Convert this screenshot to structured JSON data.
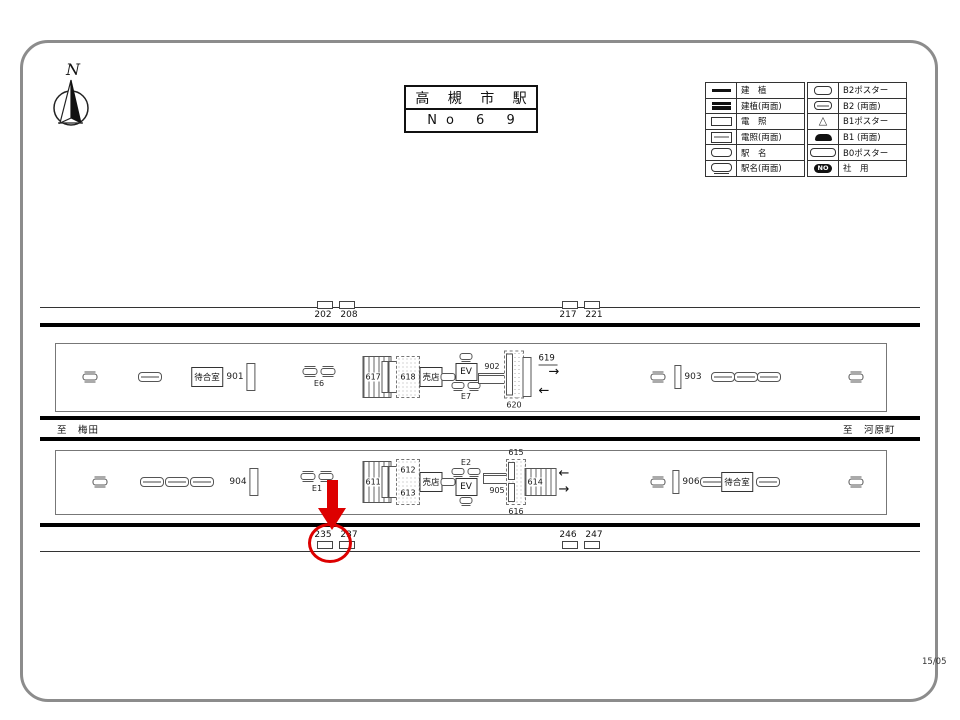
{
  "header": {
    "compass_label": "N",
    "title": "高 槻 市 駅",
    "number": "No 6 9"
  },
  "legend": {
    "rows_left": [
      {
        "icon": "kenshoku",
        "label": "建　植"
      },
      {
        "icon": "kenshoku-ryomen",
        "label": "建植(両面)"
      },
      {
        "icon": "densho",
        "label": "電　照"
      },
      {
        "icon": "densho-ryomen",
        "label": "電照(両面)"
      },
      {
        "icon": "ekimei",
        "label": "駅　名"
      },
      {
        "icon": "ekimei-ryomen",
        "label": "駅名(両面)"
      }
    ],
    "rows_right": [
      {
        "icon": "b2-poster",
        "label": "B2ポスター"
      },
      {
        "icon": "b2-ryomen",
        "label": "B2 (両面)"
      },
      {
        "icon": "b1-poster",
        "label": "B1ポスター"
      },
      {
        "icon": "b1-ryomen",
        "label": "B1 (両面)"
      },
      {
        "icon": "b0-poster",
        "label": "B0ポスター"
      },
      {
        "icon": "no-badge",
        "badge": "NO",
        "label": "社　用"
      }
    ]
  },
  "map": {
    "to_left": "至　梅田",
    "to_right": "至　河原町",
    "sheet_code": "15/05",
    "top_markers": [
      {
        "x": 336,
        "labels": [
          "202",
          "208"
        ]
      },
      {
        "x": 581,
        "labels": [
          "217",
          "221"
        ]
      }
    ],
    "bottom_markers": [
      {
        "x": 336,
        "labels": [
          "235",
          "237"
        ]
      },
      {
        "x": 581,
        "labels": [
          "246",
          "247"
        ]
      }
    ],
    "highlight": {
      "target": "235",
      "color": "#dd0000",
      "arrow": {
        "x": 332,
        "top": 480,
        "shaft_h": 28,
        "head_h": 22
      },
      "circle": {
        "cx": 330,
        "cy": 543,
        "rx": 19,
        "ry": 17
      }
    },
    "platforms": [
      {
        "name": "platform-top",
        "box": {
          "x": 55,
          "y": 343,
          "w": 830,
          "h": 67
        },
        "items": [
          {
            "t": "sym2",
            "x": 90
          },
          {
            "t": "oval",
            "x": 150
          },
          {
            "t": "room",
            "x": 207,
            "label": "待合室"
          },
          {
            "t": "numbar",
            "x": 241,
            "label": "901"
          },
          {
            "t": "sympair",
            "x": 319,
            "label": "E6"
          },
          {
            "t": "stairs",
            "x": 377,
            "label": "617",
            "w": 27,
            "h": 40
          },
          {
            "t": "vrect",
            "x": 393,
            "h": 30
          },
          {
            "t": "dashedbox",
            "x": 408,
            "label": "618",
            "w": 22,
            "h": 40
          },
          {
            "t": "room",
            "x": 431,
            "label": "売店"
          },
          {
            "t": "ovalsm",
            "x": 448
          },
          {
            "t": "ev",
            "x": 466,
            "label": "EV",
            "bottomLabel": "E7",
            "topSyms": 1,
            "bottomSyms": 2
          },
          {
            "t": "densho",
            "x": 492,
            "label": "902",
            "labelPos": "top",
            "dy": -4
          },
          {
            "t": "dashedbars",
            "x": 514,
            "labelBottom": "620",
            "w": 18,
            "h": 46,
            "bars": "full",
            "dy": 3
          },
          {
            "t": "vrect",
            "x": 527,
            "h": 38
          },
          {
            "t": "arrows",
            "x": 549,
            "label": "619",
            "dy": -2
          },
          {
            "t": "sym2",
            "x": 658
          },
          {
            "t": "numbar2",
            "x": 688,
            "label": "903"
          },
          {
            "t": "oval",
            "x": 723
          },
          {
            "t": "oval",
            "x": 746
          },
          {
            "t": "oval",
            "x": 769
          },
          {
            "t": "sym2",
            "x": 856
          }
        ]
      },
      {
        "name": "platform-bottom",
        "box": {
          "x": 55,
          "y": 450,
          "w": 830,
          "h": 63
        },
        "items": [
          {
            "t": "sym2",
            "x": 100
          },
          {
            "t": "oval",
            "x": 152
          },
          {
            "t": "oval",
            "x": 177
          },
          {
            "t": "oval",
            "x": 202
          },
          {
            "t": "numbar",
            "x": 244,
            "label": "904"
          },
          {
            "t": "sympair",
            "x": 317,
            "label": "E1"
          },
          {
            "t": "stairs",
            "x": 377,
            "label": "611",
            "w": 27,
            "h": 40
          },
          {
            "t": "vrect",
            "x": 393,
            "h": 30
          },
          {
            "t": "dashedbox2",
            "x": 408,
            "labels": [
              "612",
              "613"
            ],
            "w": 22,
            "h": 44
          },
          {
            "t": "room",
            "x": 431,
            "label": "売店"
          },
          {
            "t": "ovalsm",
            "x": 448
          },
          {
            "t": "ev",
            "x": 466,
            "label": "EV",
            "topLabel": "E2",
            "topSyms": 2,
            "bottomSyms": 1
          },
          {
            "t": "densho",
            "x": 497,
            "label": "905",
            "labelPos": "bottom",
            "dy": 2
          },
          {
            "t": "dashedbars",
            "x": 516,
            "labelTop": "615",
            "labelBottom": "616",
            "w": 18,
            "h": 44,
            "bars": "split"
          },
          {
            "t": "stairs614",
            "x": 547,
            "label": "614",
            "w": 30,
            "h": 26
          },
          {
            "t": "sym2",
            "x": 658
          },
          {
            "t": "numbar2",
            "x": 686,
            "label": "906"
          },
          {
            "t": "oval",
            "x": 712
          },
          {
            "t": "room",
            "x": 737,
            "label": "待合室"
          },
          {
            "t": "oval",
            "x": 768
          },
          {
            "t": "sym2",
            "x": 856
          }
        ]
      }
    ]
  }
}
